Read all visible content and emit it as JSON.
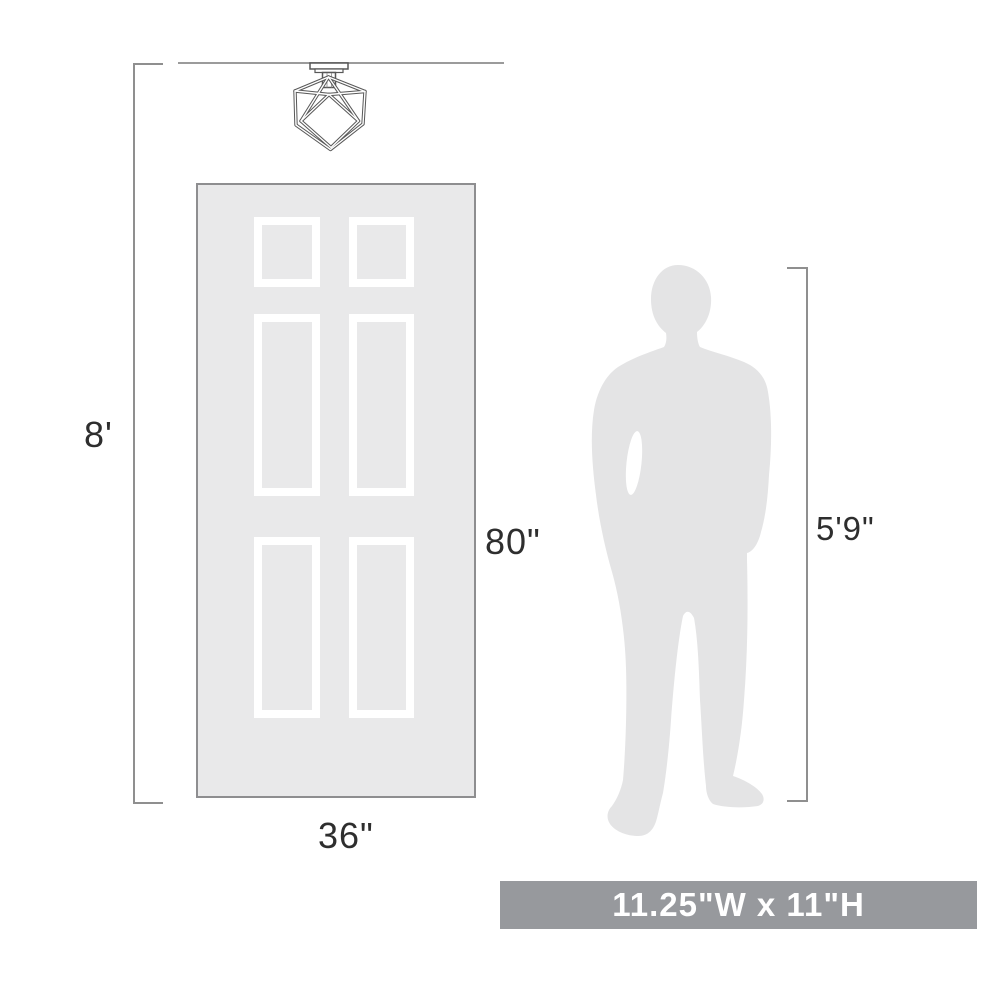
{
  "diagram": {
    "title_hint": "product scale diagram",
    "ceiling_height_label": "8'",
    "door_height_label": "80\"",
    "door_width_label": "36\"",
    "person_height_label": "5'9\"",
    "fixture_dimensions_label": "11.25\"W x 11\"H"
  },
  "reference_objects": {
    "door": {
      "width_in": 36,
      "height_in": 80,
      "panels": 6
    },
    "person": {
      "height": "5'9\""
    },
    "ceiling": {
      "height_ft": 8
    },
    "fixture": {
      "width_in": 11.25,
      "height_in": 11,
      "type": "cube cage semi-flush ceiling light"
    }
  },
  "colors": {
    "background": "#ffffff",
    "door_fill": "#e9e9ea",
    "door_border": "#8e8e90",
    "panel_outline": "#ffffff",
    "silhouette_fill": "#e4e4e5",
    "dimension_line": "#8f8f8f",
    "label_text": "#2e2e2e",
    "banner_background": "#97999d",
    "banner_text": "#ffffff",
    "fixture_stroke": "#585858"
  }
}
